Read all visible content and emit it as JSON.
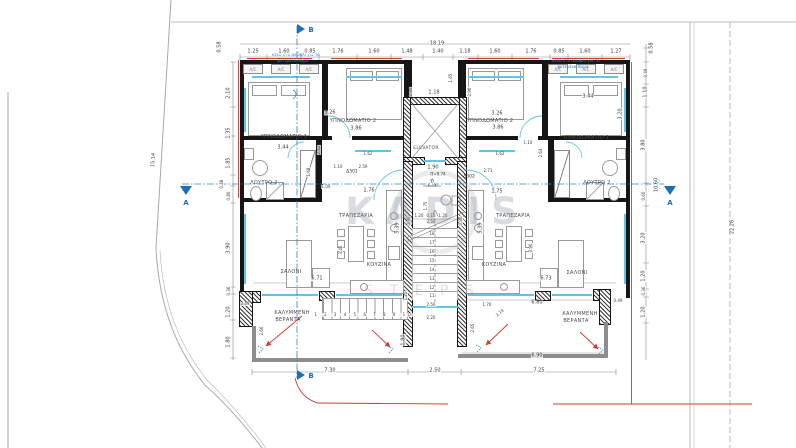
{
  "watermark": {
    "line1": "KADIS",
    "line2": "S T E P S"
  },
  "labels": {
    "ac": "A/C",
    "elevator": "ELEVATOR",
    "bedroom1": "ΥΠΝΟΔΩΜΑΤΙΟ 1",
    "bedroom2": "ΥΠΝΟΔΩΜΑΤΙΟ 2",
    "bathroom": "ΛΟΥΤΡΟ 2",
    "dining": "ΤΡΑΠΕΖΑΡΙΑ",
    "kitchen": "ΚΟΥΖΙΝΑ",
    "living": "ΣΑΛΟΝΙ",
    "veranda1": "ΚΑΛΥΜΜΕΝΗ",
    "veranda2": "ΒΕΡΑΝΤΑ"
  },
  "units": {
    "left": "Δ301",
    "right": "Δ302"
  },
  "level": {
    "text": "Π=9.74",
    "sub": "Υ/"
  },
  "sections": {
    "a": "A",
    "b": "B"
  },
  "notes": {
    "l1": "κενό στο ανώφλι για το",
    "l2": "φυτεμένο δώμα"
  },
  "annotations": [
    {
      "t": "18.19",
      "x": 437,
      "y": 44
    },
    {
      "t": "1.25",
      "x": 253,
      "y": 52
    },
    {
      "t": "1.60",
      "x": 284,
      "y": 52
    },
    {
      "t": "0.85",
      "x": 310,
      "y": 52
    },
    {
      "t": "1.76",
      "x": 338,
      "y": 52
    },
    {
      "t": "1.60",
      "x": 374,
      "y": 52
    },
    {
      "t": "1.48",
      "x": 407,
      "y": 52
    },
    {
      "t": "1.40",
      "x": 438,
      "y": 52
    },
    {
      "t": "1.18",
      "x": 465,
      "y": 52
    },
    {
      "t": "1.60",
      "x": 495,
      "y": 52
    },
    {
      "t": "1.76",
      "x": 531,
      "y": 52
    },
    {
      "t": "0.85",
      "x": 559,
      "y": 52
    },
    {
      "t": "1.60",
      "x": 585,
      "y": 52
    },
    {
      "t": "1.27",
      "x": 616,
      "y": 52
    },
    {
      "t": "0.58",
      "x": 220,
      "y": 47,
      "r": -90
    },
    {
      "t": "2.10",
      "x": 229,
      "y": 93,
      "r": -90
    },
    {
      "t": "1.35",
      "x": 229,
      "y": 133,
      "r": -90
    },
    {
      "t": "1.85",
      "x": 229,
      "y": 163,
      "r": -90
    },
    {
      "t": "0.48",
      "x": 222,
      "y": 184,
      "r": -90,
      "s": 4
    },
    {
      "t": "0.80",
      "x": 229,
      "y": 196,
      "r": -90,
      "s": 4
    },
    {
      "t": "3.90",
      "x": 229,
      "y": 248,
      "r": -90
    },
    {
      "t": "0.36",
      "x": 229,
      "y": 291,
      "r": -90,
      "s": 4
    },
    {
      "t": "1.20",
      "x": 229,
      "y": 312,
      "r": -90
    },
    {
      "t": "1.80",
      "x": 229,
      "y": 342,
      "r": -90
    },
    {
      "t": "15.14",
      "x": 154,
      "y": 160,
      "r": -87
    },
    {
      "t": "0.58",
      "x": 652,
      "y": 48,
      "r": -90
    },
    {
      "t": "0.49",
      "x": 646,
      "y": 73,
      "r": -90,
      "s": 4
    },
    {
      "t": "1.10",
      "x": 646,
      "y": 92,
      "r": -90
    },
    {
      "t": "3.80",
      "x": 644,
      "y": 145,
      "r": -90
    },
    {
      "t": "10.60",
      "x": 657,
      "y": 185,
      "r": -90
    },
    {
      "t": "0.60",
      "x": 644,
      "y": 196,
      "r": -90,
      "s": 4
    },
    {
      "t": "3.20",
      "x": 644,
      "y": 238,
      "r": -90
    },
    {
      "t": "1.20",
      "x": 644,
      "y": 276,
      "r": -90
    },
    {
      "t": "0.36",
      "x": 644,
      "y": 291,
      "r": -90,
      "s": 4
    },
    {
      "t": "1.20",
      "x": 644,
      "y": 312,
      "r": -90
    },
    {
      "t": "22.26",
      "x": 733,
      "y": 227,
      "r": -90
    },
    {
      "t": "7.30",
      "x": 330,
      "y": 371
    },
    {
      "t": "2.50",
      "x": 435,
      "y": 371
    },
    {
      "t": "7.25",
      "x": 539,
      "y": 371
    },
    {
      "t": "3.26",
      "x": 330,
      "y": 113
    },
    {
      "t": "3.86",
      "x": 356,
      "y": 129
    },
    {
      "t": "3.44",
      "x": 283,
      "y": 148
    },
    {
      "t": "3.26",
      "x": 497,
      "y": 114
    },
    {
      "t": "3.86",
      "x": 498,
      "y": 128
    },
    {
      "t": "3.44",
      "x": 588,
      "y": 97
    },
    {
      "t": "1.18",
      "x": 434,
      "y": 93
    },
    {
      "t": "1.65",
      "x": 451,
      "y": 78,
      "r": -90,
      "s": 4
    },
    {
      "t": "2.95",
      "x": 411,
      "y": 92,
      "r": -90,
      "s": 4
    },
    {
      "t": "2.96",
      "x": 470,
      "y": 92,
      "r": -90,
      "s": 4
    },
    {
      "t": "1.90",
      "x": 433,
      "y": 168
    },
    {
      "t": "2.62",
      "x": 319,
      "y": 150,
      "r": -90,
      "s": 4
    },
    {
      "t": "2.64",
      "x": 541,
      "y": 153,
      "r": -90,
      "s": 4
    },
    {
      "t": "3.20",
      "x": 621,
      "y": 114,
      "r": -90
    },
    {
      "t": "1.62",
      "x": 368,
      "y": 154,
      "s": 4
    },
    {
      "t": "2.59",
      "x": 363,
      "y": 167,
      "s": 4
    },
    {
      "t": "1.10",
      "x": 338,
      "y": 167,
      "s": 4
    },
    {
      "t": "1.62",
      "x": 500,
      "y": 154,
      "s": 4
    },
    {
      "t": "2.71",
      "x": 488,
      "y": 171,
      "s": 4
    },
    {
      "t": "1.10",
      "x": 528,
      "y": 143,
      "s": 4
    },
    {
      "t": "1.68",
      "x": 309,
      "y": 172,
      "r": -90,
      "s": 4
    },
    {
      "t": "1.00",
      "x": 326,
      "y": 187,
      "s": 4
    },
    {
      "t": "1.76",
      "x": 369,
      "y": 191
    },
    {
      "t": "1.75",
      "x": 497,
      "y": 192
    },
    {
      "t": "1.20",
      "x": 419,
      "y": 216,
      "s": 4
    },
    {
      "t": "0.10",
      "x": 431,
      "y": 216,
      "s": 4
    },
    {
      "t": "1.20",
      "x": 443,
      "y": 216,
      "s": 4
    },
    {
      "t": "2.50",
      "x": 431,
      "y": 222,
      "s": 4
    },
    {
      "t": "0.90",
      "x": 409,
      "y": 221,
      "r": -90,
      "s": 4
    },
    {
      "t": "0.90",
      "x": 461,
      "y": 221,
      "r": -90,
      "s": 4
    },
    {
      "t": "1.75",
      "x": 426,
      "y": 206,
      "r": -90,
      "s": 4
    },
    {
      "t": "5.39",
      "x": 398,
      "y": 228,
      "r": -90
    },
    {
      "t": "5.39",
      "x": 481,
      "y": 228,
      "r": -90
    },
    {
      "t": "3.46",
      "x": 341,
      "y": 250,
      "r": -90,
      "s": 4
    },
    {
      "t": "3.90",
      "x": 531,
      "y": 248,
      "r": -90,
      "s": 4
    },
    {
      "t": "6.71",
      "x": 317,
      "y": 279
    },
    {
      "t": "6.73",
      "x": 546,
      "y": 279
    },
    {
      "t": "6.80",
      "x": 537,
      "y": 303
    },
    {
      "t": "6.90",
      "x": 537,
      "y": 356
    },
    {
      "t": "0.49",
      "x": 245,
      "y": 304,
      "s": 4
    },
    {
      "t": "0.49",
      "x": 618,
      "y": 301,
      "s": 4
    },
    {
      "t": "2.66",
      "x": 262,
      "y": 331,
      "r": -90,
      "s": 4
    },
    {
      "t": "2.65",
      "x": 473,
      "y": 328,
      "r": -90,
      "s": 4
    },
    {
      "t": "1.70",
      "x": 487,
      "y": 305,
      "s": 4
    },
    {
      "t": "2.19",
      "x": 500,
      "y": 313,
      "r": -40,
      "s": 4
    },
    {
      "t": "1.20",
      "x": 406,
      "y": 296,
      "r": -90,
      "s": 4
    },
    {
      "t": "2.50",
      "x": 431,
      "y": 305,
      "s": 4
    },
    {
      "t": "2.20",
      "x": 431,
      "y": 318,
      "s": 4
    },
    {
      "t": "1.80",
      "x": 404,
      "y": 340,
      "r": -90
    },
    {
      "t": "18",
      "x": 432,
      "y": 234,
      "s": 4
    },
    {
      "t": "17",
      "x": 432,
      "y": 243,
      "s": 4
    },
    {
      "t": "16",
      "x": 432,
      "y": 252,
      "s": 4
    },
    {
      "t": "15",
      "x": 432,
      "y": 261,
      "s": 4
    },
    {
      "t": "14",
      "x": 432,
      "y": 270,
      "s": 4
    },
    {
      "t": "13",
      "x": 432,
      "y": 279,
      "s": 4
    },
    {
      "t": "12",
      "x": 432,
      "y": 288,
      "s": 4
    },
    {
      "t": "11",
      "x": 432,
      "y": 296,
      "s": 4
    },
    {
      "t": "1 2 3 4 5 6 7 8 9 10",
      "x": 364,
      "y": 315,
      "s": 4,
      "sp": 3
    },
    {
      "t": "Υ/",
      "x": 432,
      "y": 182,
      "s": 4
    }
  ]
}
